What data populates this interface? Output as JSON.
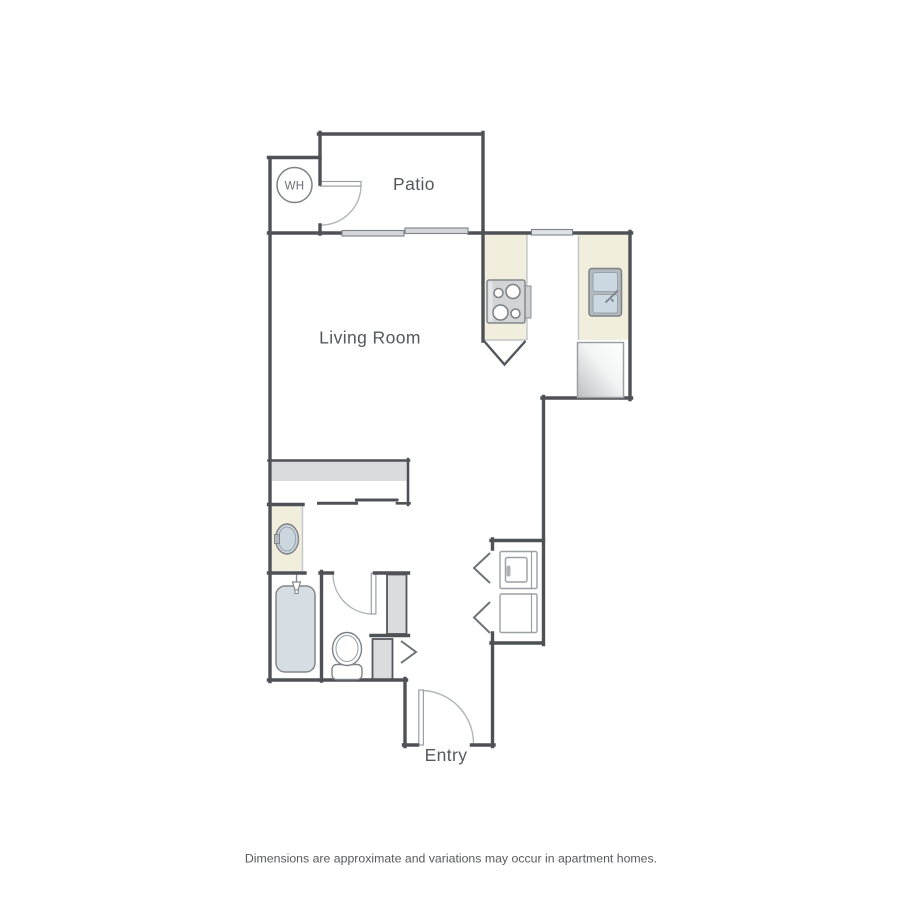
{
  "page": {
    "width_px": 900,
    "height_px": 900,
    "background": "#ffffff",
    "type": "apartment floor plan (studio)"
  },
  "floor_plan": {
    "labels": {
      "patio": "Patio",
      "living_room": "Living Room",
      "entry": "Entry",
      "water_heater_abbr": "WH"
    },
    "disclaimer": "Dimensions are approximate and variations may occur in apartment homes.",
    "colors": {
      "wall": "#4e5156",
      "counter_beige": "#f2eedd",
      "fixture_blue_gray": "#d7dee3",
      "sink_basin_blue": "#ccd8e2",
      "shelf_gray": "#d9dbdd",
      "window_gray": "#d2d6d8",
      "kitchen_window_gray": "#dde2e6",
      "chase_gray": "#dadcde",
      "appliance_outline_gray": "#9aa0a4",
      "door_arc_gray": "#b0b5b9",
      "label_text": "#55585c",
      "disclaimer_text": "#58595b"
    },
    "rooms": [
      "Patio",
      "Living Room",
      "Kitchen",
      "Bathroom",
      "Entry"
    ],
    "fixtures": [
      "water-heater",
      "patio-door",
      "sliding-glass-door",
      "kitchen-window",
      "stove",
      "kitchen-sink",
      "refrigerator",
      "kitchen-peninsula",
      "wardrobe-closet-bypass-doors",
      "vanity-sink",
      "bathtub-shower",
      "toilet",
      "bathroom-door",
      "stacked-washer-dryer",
      "laundry-closet-bifold-doors",
      "coat-closet-door",
      "entry-door"
    ]
  }
}
